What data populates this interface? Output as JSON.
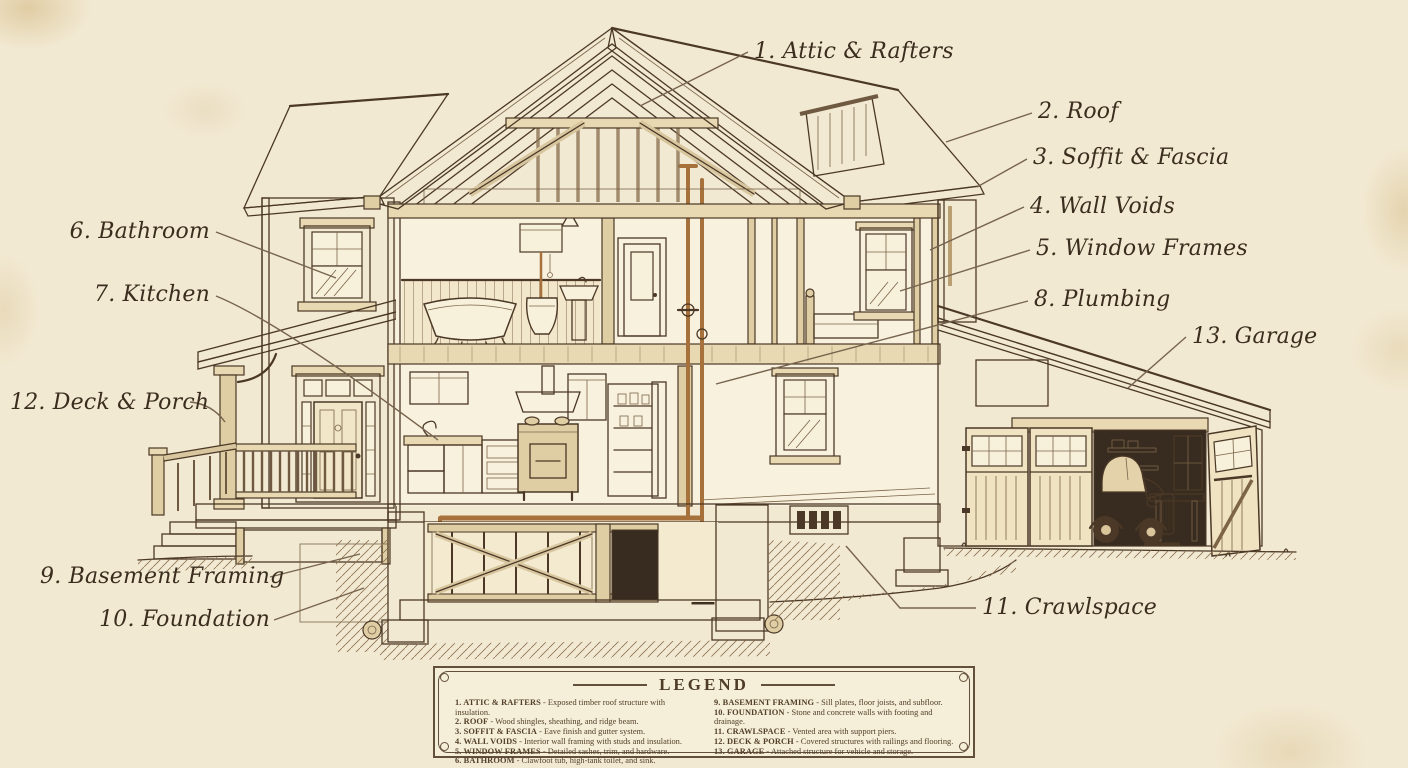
{
  "palette": {
    "paper": "#f2e9d2",
    "ink": "#4b3826",
    "leader": "#77644e",
    "copper": "#a6713a",
    "wood": "#e9d9b2"
  },
  "callouts": {
    "attic": {
      "label": "1. Attic & Rafters"
    },
    "roof": {
      "label": "2. Roof"
    },
    "soffit": {
      "label": "3. Soffit & Fascia"
    },
    "wallvoids": {
      "label": "4. Wall Voids"
    },
    "windowframes": {
      "label": "5. Window Frames"
    },
    "bathroom": {
      "label": "6. Bathroom"
    },
    "kitchen": {
      "label": "7. Kitchen"
    },
    "plumbing": {
      "label": "8. Plumbing"
    },
    "basement": {
      "label": "9. Basement Framing"
    },
    "foundation": {
      "label": "10. Foundation"
    },
    "crawlspace": {
      "label": "11. Crawlspace"
    },
    "deckporch": {
      "label": "12. Deck & Porch"
    },
    "garage": {
      "label": "13. Garage"
    }
  },
  "legend": {
    "title": "LEGEND",
    "left": [
      {
        "label": "1. ATTIC & RAFTERS",
        "desc": " - Exposed timber roof structure with insulation."
      },
      {
        "label": "2. ROOF",
        "desc": " - Wood shingles, sheathing, and ridge beam."
      },
      {
        "label": "3. SOFFIT & FASCIA",
        "desc": " - Eave finish and gutter system."
      },
      {
        "label": "4. WALL VOIDS",
        "desc": " - Interior wall framing with studs and insulation."
      },
      {
        "label": "5. WINDOW FRAMES",
        "desc": " - Detailed sashes, trim, and hardware."
      },
      {
        "label": "6. BATHROOM",
        "desc": " - Clawfoot tub, high-tank toilet, and sink."
      }
    ],
    "right": [
      {
        "label": "9. BASEMENT FRAMING",
        "desc": " - Sill plates, floor joists, and subfloor."
      },
      {
        "label": "10. FOUNDATION",
        "desc": " - Stone and concrete walls with footing and drainage."
      },
      {
        "label": "11. CRAWLSPACE",
        "desc": " - Vented area with support piers."
      },
      {
        "label": "12. DECK & PORCH",
        "desc": " - Covered structures with railings and flooring."
      },
      {
        "label": "13. GARAGE",
        "desc": " - Attached structure for vehicle and storage."
      }
    ]
  }
}
